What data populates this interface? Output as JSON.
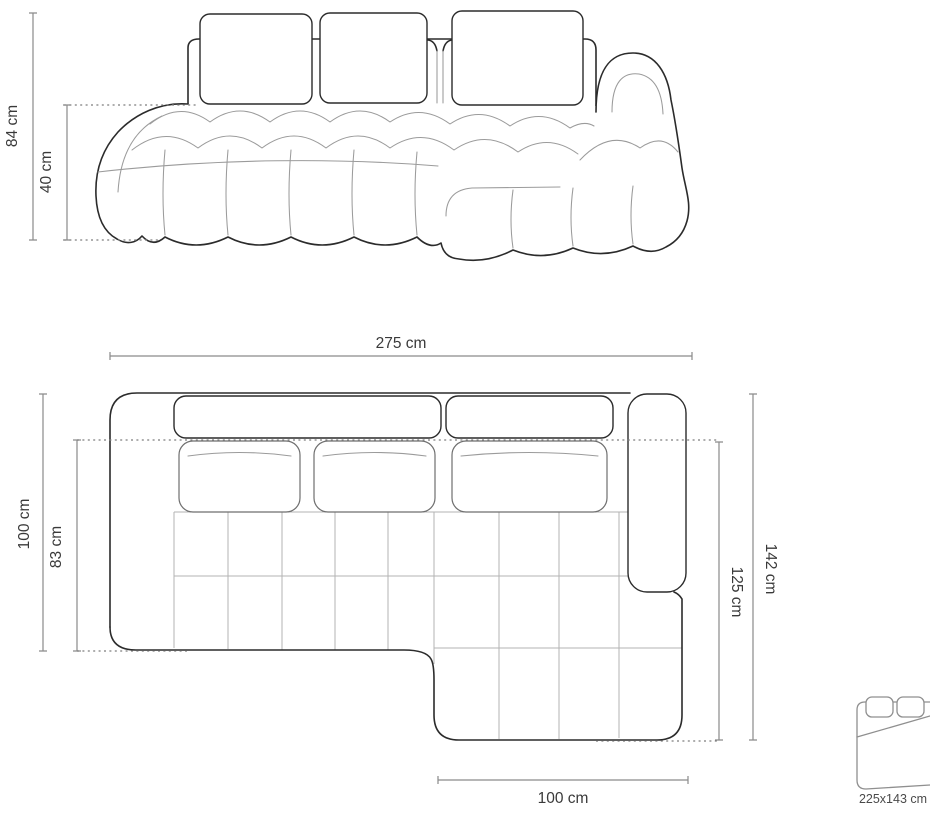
{
  "diagram": {
    "title": "corner-sofa-dimension-drawing",
    "front_view": {
      "overall_height": "84 cm",
      "seat_height": "40 cm"
    },
    "top_view": {
      "overall_width": "275 cm",
      "left_depth": "100 cm",
      "left_seat_depth": "83 cm",
      "right_depth_total": "142 cm",
      "right_depth_inner": "125 cm",
      "chaise_width": "100 cm"
    },
    "sleeping_function": {
      "icon": "sofa-bed-icon",
      "bed_size": "225x143 cm"
    },
    "colors": {
      "background": "#ffffff",
      "outline": "#2b2b2b",
      "seam": "#9b9b9b",
      "grid": "#b3b3b3",
      "dimension_line": "#8a8a8a",
      "label_text": "#3a3a3a"
    }
  }
}
